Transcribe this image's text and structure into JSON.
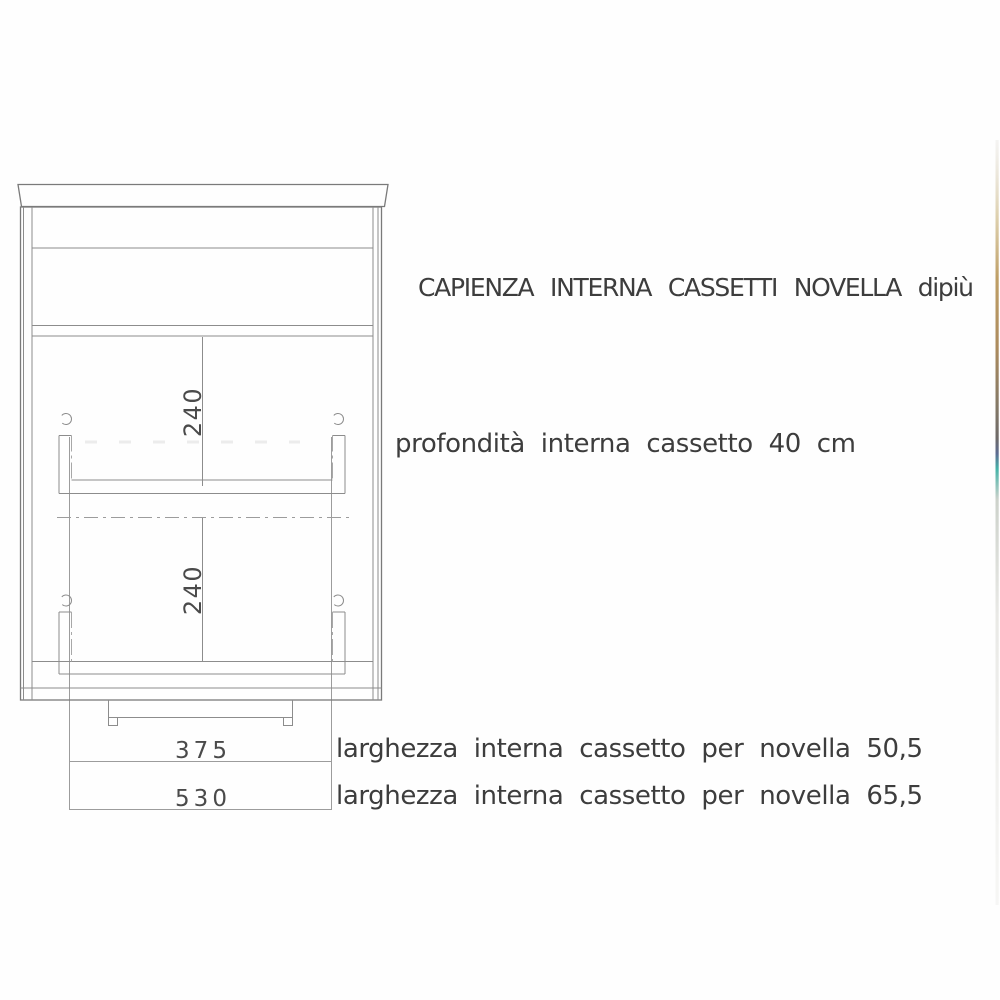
{
  "drawing": {
    "title": "CAPIENZA INTERNA CASSETTI NOVELLA dipiù",
    "notes": {
      "depth": "profondità interna cassetto 40 cm",
      "width_novella_505": "larghezza interna cassetto per novella 50,5",
      "width_novella_655": "larghezza interna cassetto per novella 65,5"
    },
    "dimensions": {
      "upper_drawer_internal_height": "240",
      "lower_drawer_internal_height": "240",
      "plinth_width": "375",
      "base_width": "530"
    },
    "colors": {
      "background": "#fefefe",
      "drawing_line": "#7a7a7a",
      "dimension_line": "#9c9c9c",
      "text": "#3d3d3d",
      "edge_strip_tan": "#bf9f66",
      "edge_strip_blue": "#5d6c92",
      "edge_strip_teal": "#45b3a8"
    }
  }
}
